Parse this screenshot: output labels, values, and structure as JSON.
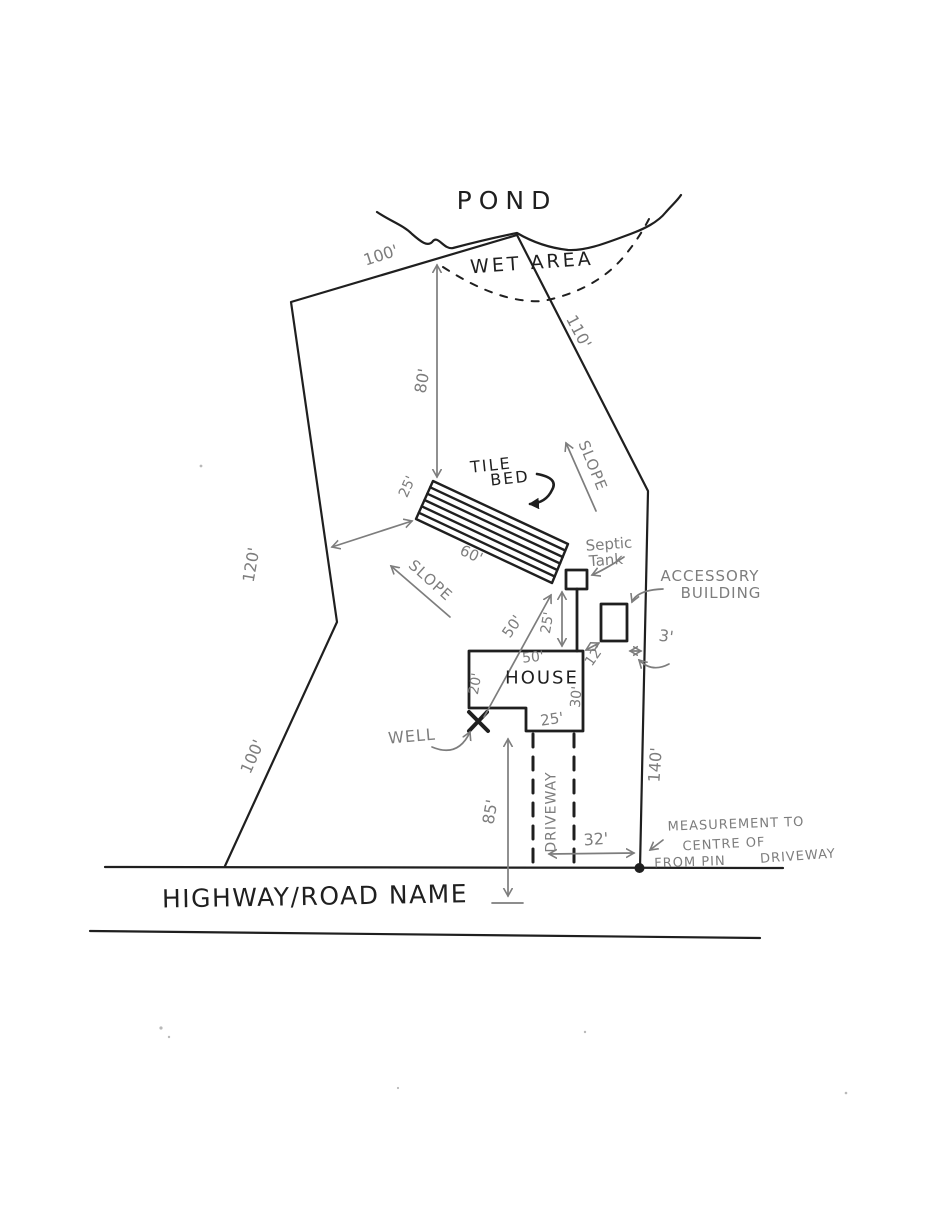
{
  "colors": {
    "ink": "#1f1f1f",
    "pencil": "#7d7d7d",
    "paper": "#ffffff"
  },
  "labels": {
    "pond": "POND",
    "wet_area": "WET AREA",
    "tile_bed": {
      "line1": "TILE",
      "line2": "BED"
    },
    "septic_tank": {
      "line1": "Septic",
      "line2": "Tank"
    },
    "accessory_building": {
      "line1": "ACCESSORY",
      "line2": "BUILDING"
    },
    "house": "HOUSE",
    "well": "WELL",
    "slope_upper": "SLOPE",
    "slope_lower": "SLOPE",
    "driveway": "DRIVEWAY",
    "highway": "HIGHWAY/ROAD NAME",
    "pin_note": {
      "line1": "MEASUREMENT TO",
      "line2": "CENTRE OF",
      "line3": "DRIVEWAY",
      "line4": "FROM PIN"
    }
  },
  "dimensions": {
    "boundary_top": "100'",
    "boundary_upper_right": "110'",
    "boundary_left_upper": "120'",
    "boundary_left_lower": "100'",
    "boundary_right": "140'",
    "pond_to_tile_bed": "80'",
    "tile_bed_width": "25'",
    "tile_bed_length": "60'",
    "tank_to_house": "25'",
    "well_to_tank": "50'",
    "house_front_width": "50'",
    "house_left_side": "20'",
    "house_right_side": "30'",
    "house_rear_wing": "25'",
    "house_to_road": "85'",
    "driveway_to_pin": "32'",
    "house_to_accessory": "12'",
    "accessory_to_line": "3'"
  }
}
